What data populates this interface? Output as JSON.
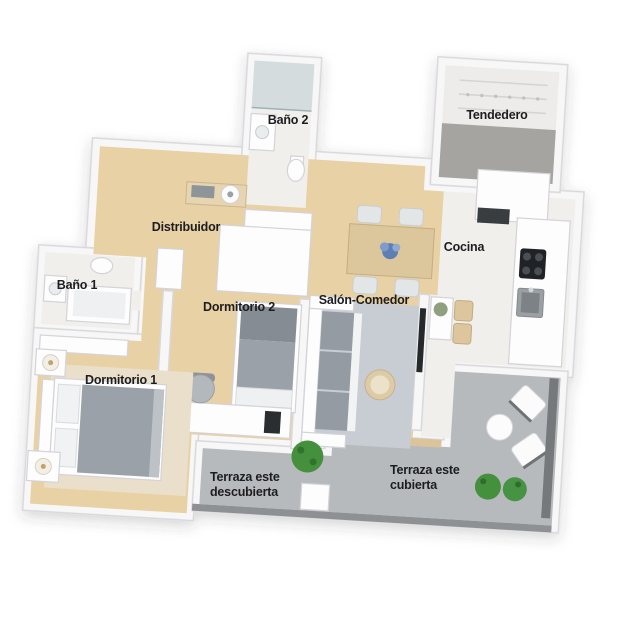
{
  "page": {
    "background": "#ffffff"
  },
  "palette": {
    "wall": "#f7f7f8",
    "wall_edge": "#d8d8dc",
    "wood_floor": "#e9d1a6",
    "tile_floor": "#f1efec",
    "terrace_floor": "#b7babc",
    "terrace_edge": "#8e9194",
    "tendedero_floor": "#a6a4a1",
    "rug_gray": "#c8cdd3",
    "furniture_gray": "#949ba2",
    "plant_green": "#44903d",
    "accent_blue": "#5d7fb5",
    "label_ink": "#1d1d1f"
  },
  "rooms": {
    "bano2": {
      "label": "Baño 2"
    },
    "tendedero": {
      "label": "Tendedero"
    },
    "distribuidor": {
      "label": "Distribuidor"
    },
    "cocina": {
      "label": "Cocina"
    },
    "bano1": {
      "label": "Baño 1"
    },
    "dormitorio2": {
      "label": "Dormitorio 2"
    },
    "salon_comedor": {
      "label": "Salón-Comedor"
    },
    "dormitorio1": {
      "label": "Dormitorio 1"
    },
    "terraza_descubierta": {
      "line1": "Terraza este",
      "line2": "descubierta"
    },
    "terraza_cubierta": {
      "line1": "Terraza este",
      "line2": "cubierta"
    }
  }
}
